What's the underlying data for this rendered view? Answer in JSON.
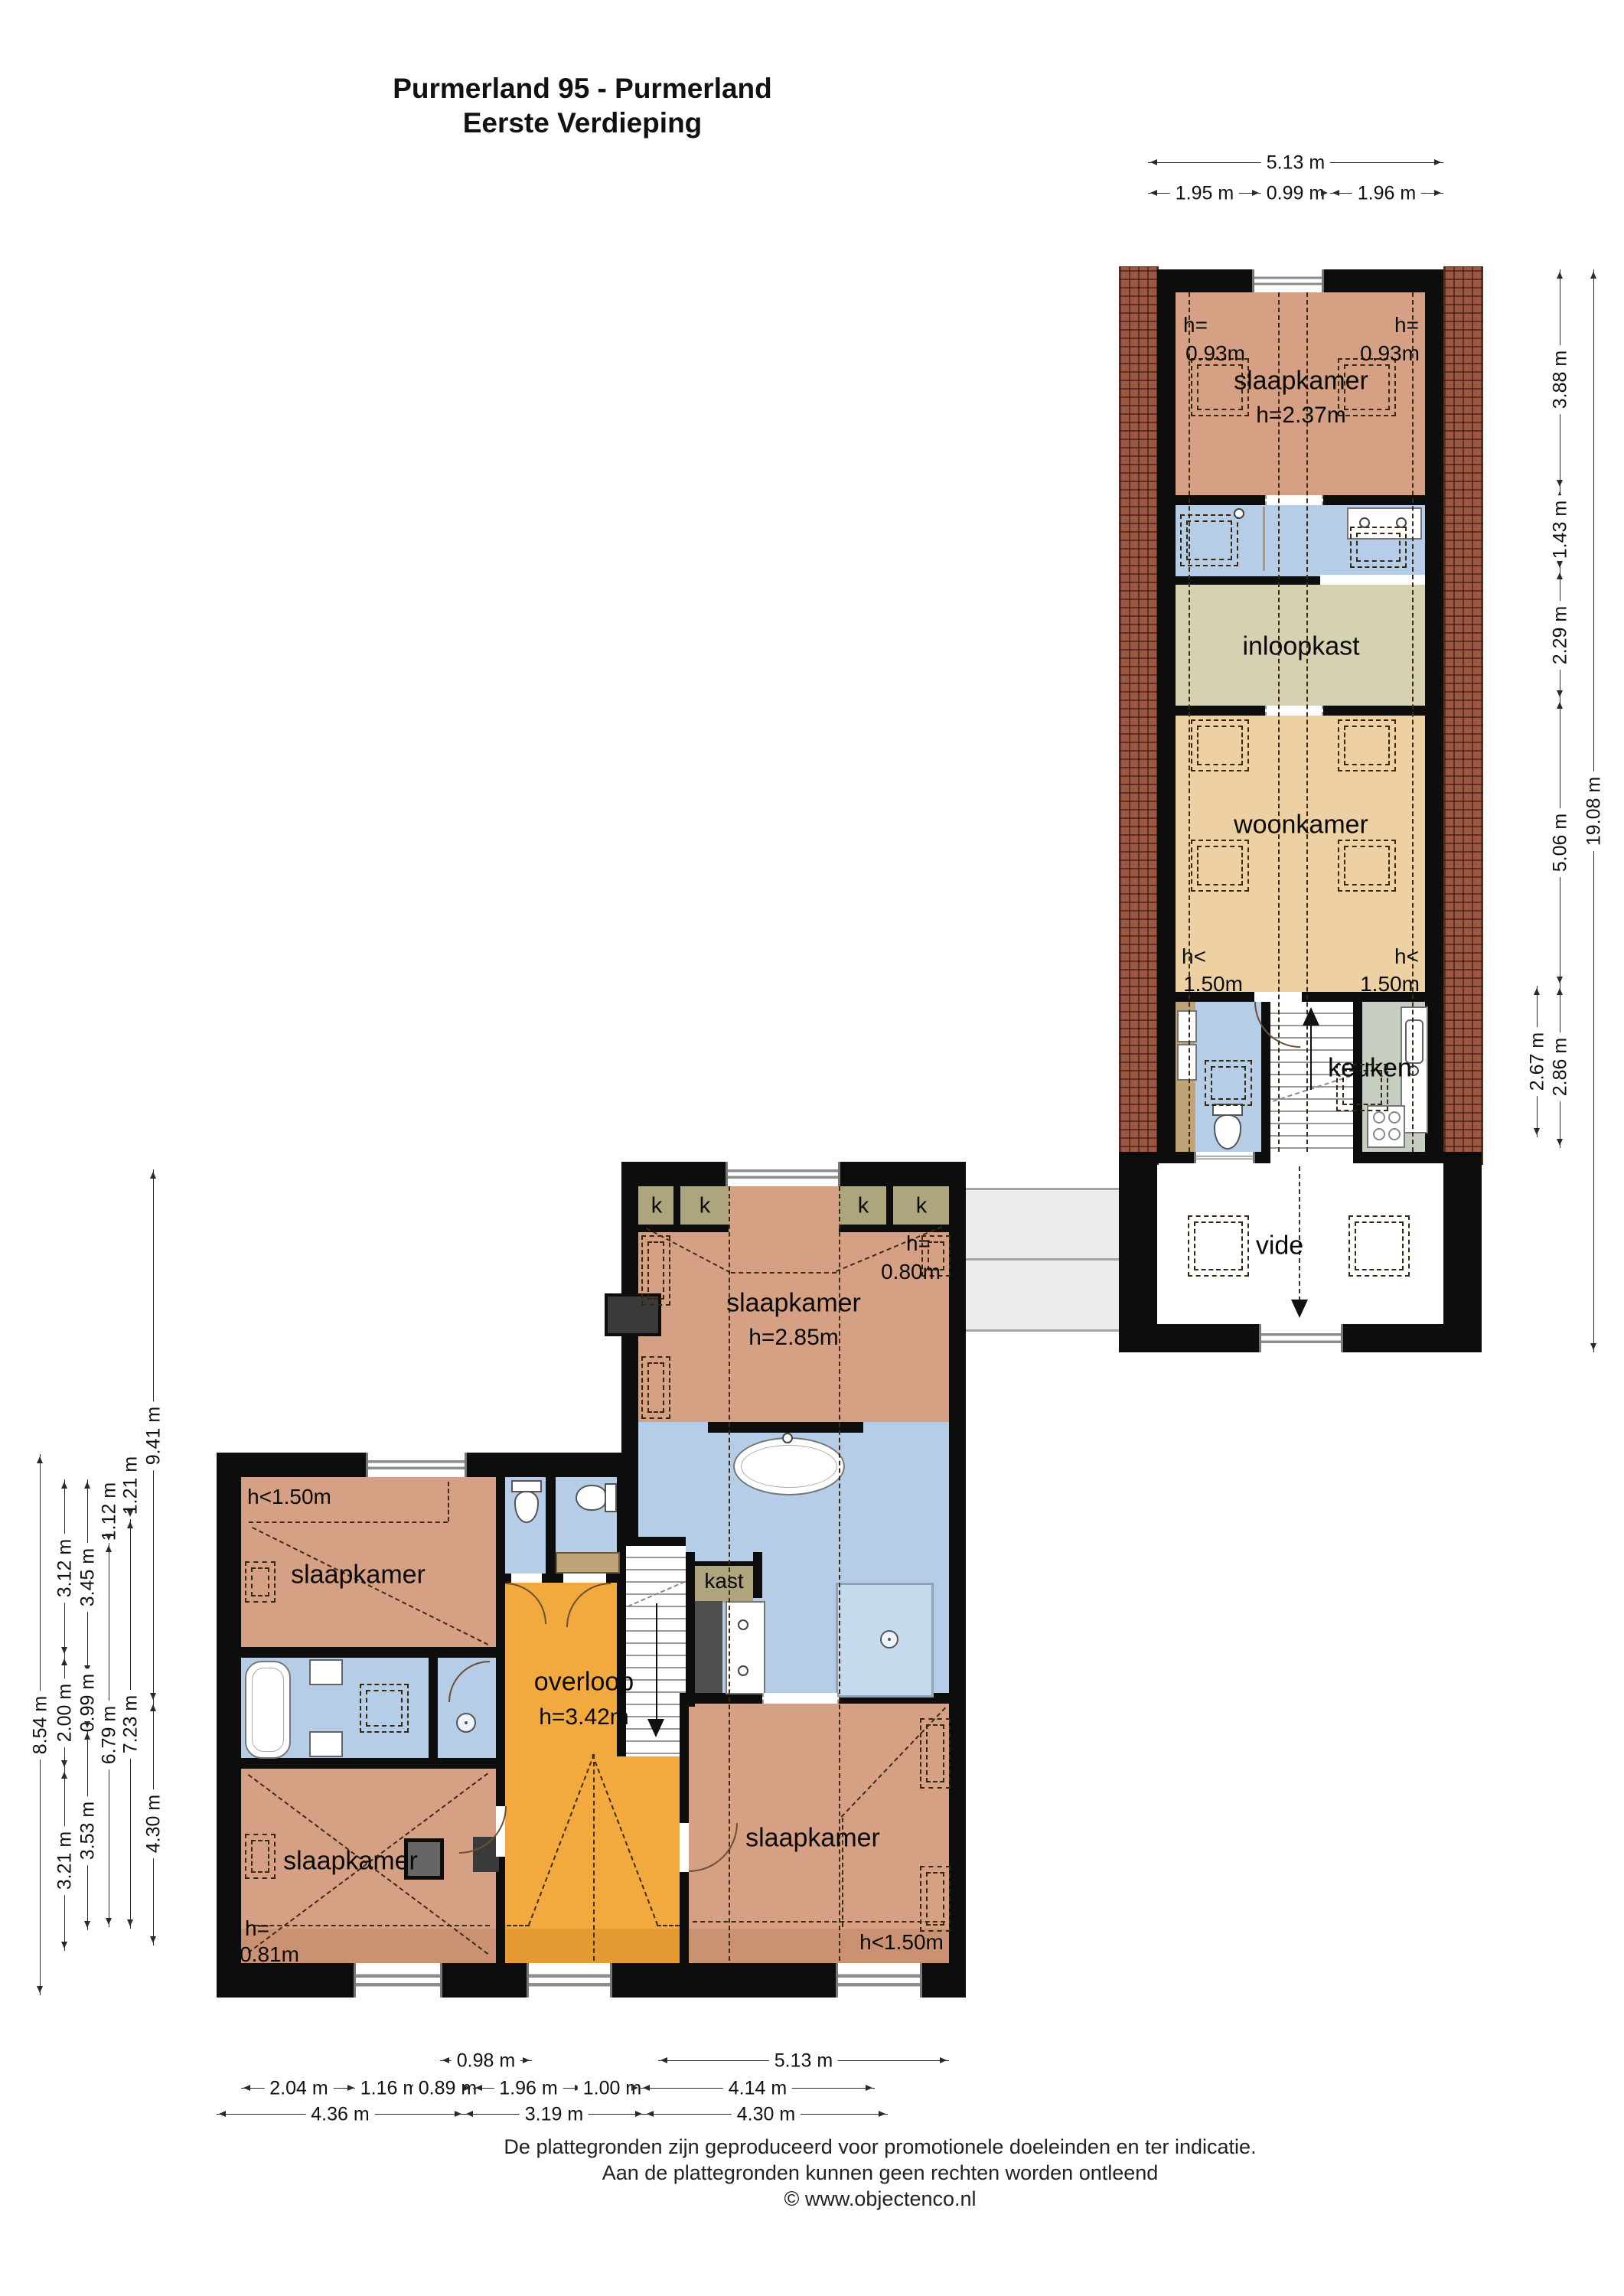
{
  "title": {
    "line1": "Purmerland 95 - Purmerland",
    "line2": "Eerste Verdieping"
  },
  "colors": {
    "salmon": "#d6a084",
    "blue": "#b5cde7",
    "wheat": "#edd1a3",
    "khaki": "#d6d1b2",
    "closet": "#aea47e",
    "green": "#c5cec0",
    "orange": "#f2a93e",
    "tan": "#bfa478",
    "brick": "#9a5843",
    "wall": "#0d0d0d"
  },
  "rooms": {
    "up_bedroom": {
      "name": "slaapkamer",
      "height": "h=2.37m",
      "h_left_1": "h=",
      "h_left_2": "0.93m",
      "h_right_1": "h=",
      "h_right_2": "0.93m"
    },
    "inloopkast": {
      "name": "inloopkast"
    },
    "woonkamer": {
      "name": "woonkamer",
      "h_left_1": "h<",
      "h_left_2": "1.50m",
      "h_right_1": "h<",
      "h_right_2": "1.50m"
    },
    "keuken": {
      "name": "keuken"
    },
    "vide": {
      "name": "vide"
    },
    "nw_bedroom": {
      "name": "slaapkamer",
      "height": "h=2.85m",
      "h_corner_1": "h=",
      "h_corner_2": "0.80m"
    },
    "closet_letter": "k",
    "kast": "kast",
    "w_bedroom": {
      "name": "slaapkamer",
      "h_corner": "h<1.50m"
    },
    "overloop": {
      "name": "overloop",
      "height": "h=3.42m"
    },
    "sw_bedroom": {
      "name": "slaapkamer",
      "h_corner_1": "h=",
      "h_corner_2": "0.81m"
    },
    "se_bedroom": {
      "name": "slaapkamer",
      "h_corner": "h<1.50m"
    }
  },
  "dims": {
    "top_total": "5.13 m",
    "top_parts": [
      "1.95 m",
      "0.99 m",
      "1.96 m"
    ],
    "right_chain": [
      "3.88 m",
      "1.43 m",
      "2.29 m",
      "5.06 m"
    ],
    "right_kitchen": [
      "2.67 m",
      "2.86 m"
    ],
    "right_total": "19.08 m",
    "left_a": "8.54 m",
    "left_b": [
      "3.12 m",
      "2.00 m",
      "3.21 m"
    ],
    "left_c": [
      "3.45 m",
      "0.99 m",
      "3.53 m"
    ],
    "left_d": [
      "1.12 m",
      "6.79 m"
    ],
    "left_e": [
      "1.21 m",
      "7.23 m"
    ],
    "left_f": [
      "9.41 m",
      "4.30 m"
    ],
    "bottom_row1": [
      "0.98 m",
      "5.13 m"
    ],
    "bottom_row2": [
      "2.04 m",
      "1.16 m",
      "0.89 m",
      "1.96 m",
      "1.00 m",
      "4.14 m"
    ],
    "bottom_row3": [
      "4.36 m",
      "3.19 m",
      "4.30 m"
    ]
  },
  "footer": {
    "line1": "De plattegronden zijn geproduceerd voor promotionele doeleinden en ter indicatie.",
    "line2": "Aan de plattegronden kunnen geen rechten worden ontleend",
    "line3": "© www.objectenco.nl"
  }
}
